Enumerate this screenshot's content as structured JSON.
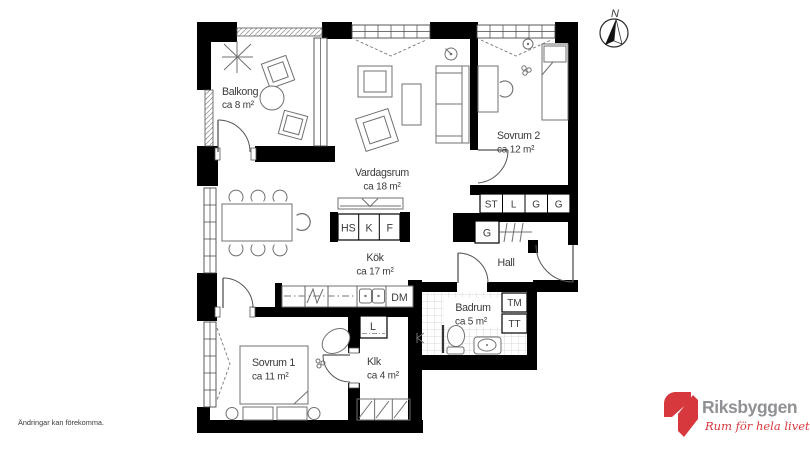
{
  "plan": {
    "rooms": [
      {
        "id": "balkong",
        "label": "Balkong",
        "area": "ca 8 m²"
      },
      {
        "id": "vardagsrum",
        "label": "Vardagsrum",
        "area": "ca 18 m²"
      },
      {
        "id": "sovrum2",
        "label": "Sovrum 2",
        "area": "ca 12 m²"
      },
      {
        "id": "kok",
        "label": "Kök",
        "area": "ca 17 m²"
      },
      {
        "id": "hall",
        "label": "Hall",
        "area": ""
      },
      {
        "id": "badrum",
        "label": "Badrum",
        "area": "ca 5 m²"
      },
      {
        "id": "sovrum1",
        "label": "Sovrum 1",
        "area": "ca 11 m²"
      },
      {
        "id": "klk",
        "label": "Klk",
        "area": "ca 4 m²"
      }
    ],
    "fixtures": {
      "closet_row": [
        "ST",
        "L",
        "G",
        "G"
      ],
      "hall_closet": "G",
      "linen_closet": "L",
      "appliances": [
        "HS",
        "K",
        "F"
      ],
      "dishwasher": "DM",
      "washer": "TM",
      "dryer": "TT"
    },
    "compass": "N"
  },
  "footer": {
    "disclaimer": "Ändringar kan förekomma."
  },
  "logo": {
    "brand": "Riksbyggen",
    "tagline": "Rum för hela livet"
  },
  "colors": {
    "wall": "#000000",
    "text": "#3a3a3a",
    "brand_red": "#d6383e",
    "brand_gray": "#8f9194",
    "tile_line": "#d8d8d8"
  }
}
